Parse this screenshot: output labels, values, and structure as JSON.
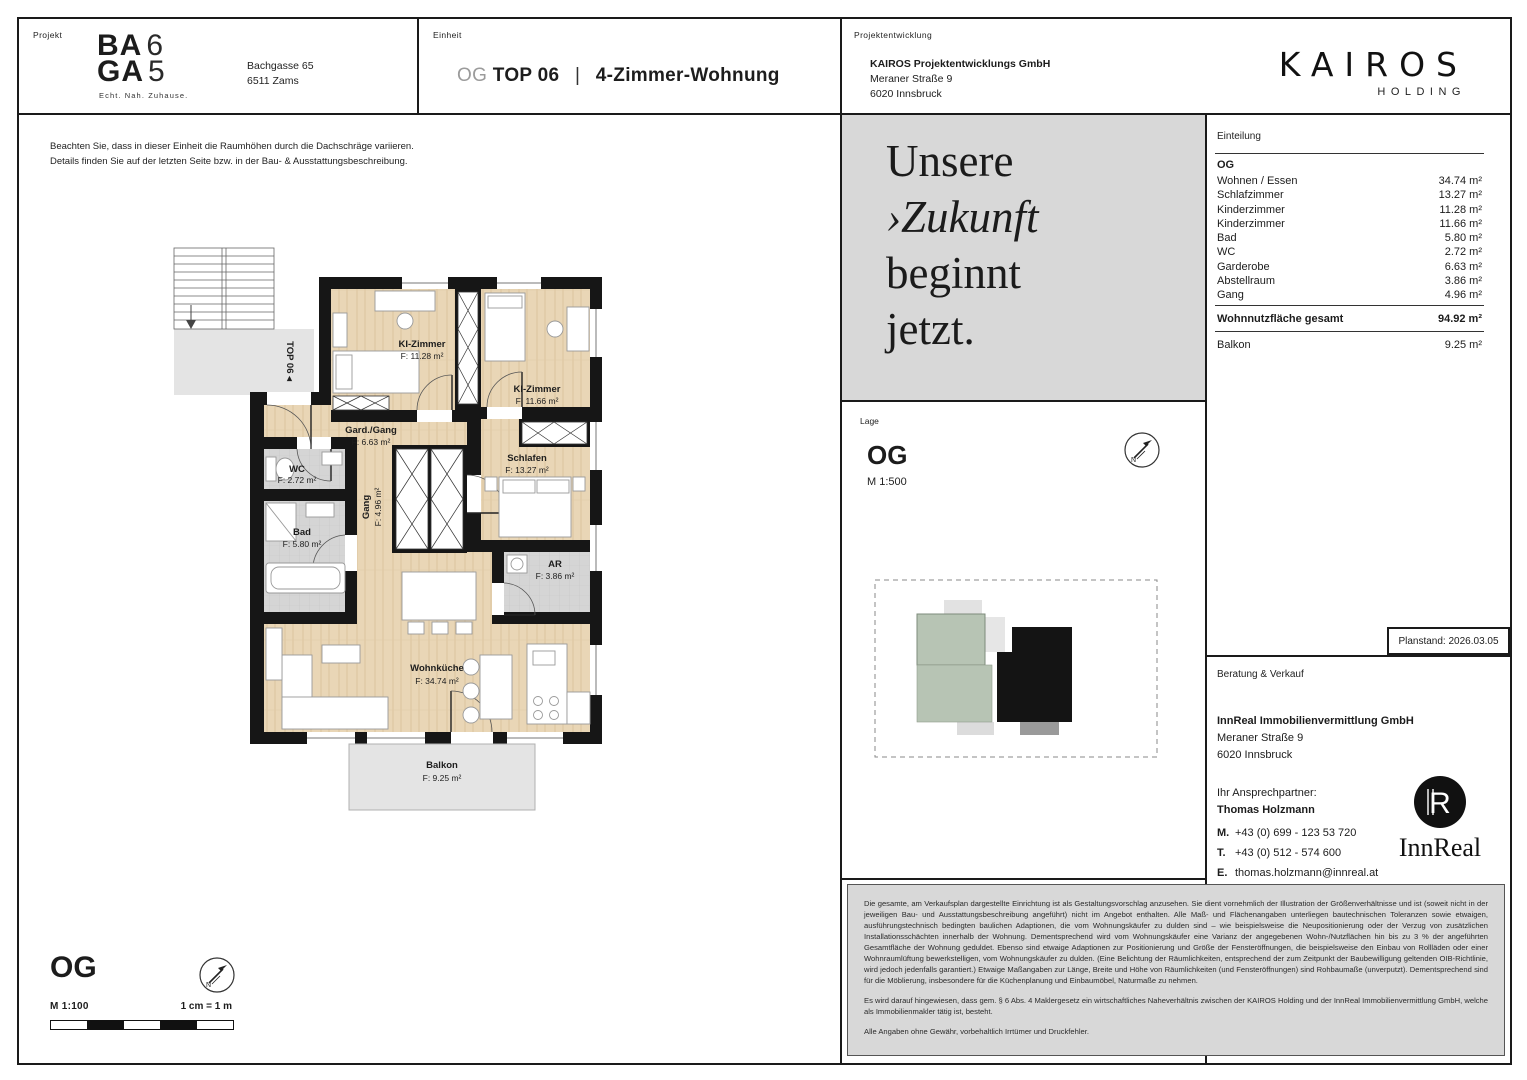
{
  "header": {
    "project_label": "Projekt",
    "logo": {
      "l1b": "BA",
      "l1t": "6",
      "l2b": "GA",
      "l2t": "5",
      "tagline": "Echt. Nah. Zuhause."
    },
    "address_line1": "Bachgasse 65",
    "address_line2": "6511 Zams",
    "unit_label": "Einheit",
    "unit_prefix": "OG",
    "unit_top": "TOP 06",
    "unit_sep": "|",
    "unit_type": "4-Zimmer-Wohnung",
    "dev_label": "Projektentwicklung",
    "dev_company": "KAIROS Projektentwicklungs GmbH",
    "dev_addr1": "Meraner Straße 9",
    "dev_addr2": "6020 Innsbruck",
    "brand_name": "KAIROS",
    "brand_sub": "HOLDING"
  },
  "notes": {
    "line1": "Beachten Sie, dass in dieser Einheit die Raumhöhen durch die Dachschräge variieren.",
    "line2": "Details finden Sie auf der letzten Seite bzw. in der Bau- & Ausstattungsbeschreibung."
  },
  "floorplan": {
    "stair_label": "TOP 06 ◂",
    "rooms": [
      {
        "name": "KI-Zimmer",
        "area": "F: 11.28 m²"
      },
      {
        "name": "KI-Zimmer",
        "area": "F: 11.66 m²"
      },
      {
        "name": "Gard./Gang",
        "area": "F: 6.63 m²"
      },
      {
        "name": "Schlafen",
        "area": "F: 13.27 m²"
      },
      {
        "name": "WC",
        "area": "F: 2.72 m²"
      },
      {
        "name": "Bad",
        "area": "F: 5.80 m²"
      },
      {
        "name": "Gang",
        "area": "F: 4.96 m²"
      },
      {
        "name": "AR",
        "area": "F: 3.86 m²"
      },
      {
        "name": "Wohnküche",
        "area": "F: 34.74 m²"
      },
      {
        "name": "Balkon",
        "area": "F: 9.25 m²"
      }
    ]
  },
  "scale_block": {
    "floor": "OG",
    "scale": "M 1:100",
    "equiv": "1 cm = 1 m"
  },
  "tagline_panel": {
    "lines": [
      "Unsere",
      "›Zukunft",
      "beginnt",
      "jetzt."
    ]
  },
  "lage": {
    "label": "Lage",
    "floor": "OG",
    "scale": "M 1:500"
  },
  "einteilung": {
    "title": "Einteilung",
    "floor": "OG",
    "rows": [
      {
        "label": "Wohnen / Essen",
        "value": "34.74 m²"
      },
      {
        "label": "Schlafzimmer",
        "value": "13.27 m²"
      },
      {
        "label": "Kinderzimmer",
        "value": "11.28 m²"
      },
      {
        "label": "Kinderzimmer",
        "value": "11.66 m²"
      },
      {
        "label": "Bad",
        "value": "5.80 m²"
      },
      {
        "label": "WC",
        "value": "2.72 m²"
      },
      {
        "label": "Garderobe",
        "value": "6.63 m²"
      },
      {
        "label": "Abstellraum",
        "value": "3.86 m²"
      },
      {
        "label": "Gang",
        "value": "4.96 m²"
      }
    ],
    "total_label": "Wohnnutzfläche gesamt",
    "total_value": "94.92 m²",
    "balkon_label": "Balkon",
    "balkon_value": "9.25 m²"
  },
  "planstand": "Planstand: 2026.03.05",
  "sales": {
    "label": "Beratung & Verkauf",
    "company": "InnReal Immobilienvermittlung GmbH",
    "addr1": "Meraner Straße 9",
    "addr2": "6020 Innsbruck",
    "partner_label": "Ihr Ansprechpartner:",
    "partner_name": "Thomas Holzmann",
    "m_label": "M.",
    "m_value": "+43 (0) 699 - 123 53 720",
    "t_label": "T.",
    "t_value": "+43 (0) 512 - 574 600",
    "e_label": "E.",
    "e_value": "thomas.holzmann@innreal.at",
    "logo_word": "InnReal"
  },
  "disclaimer": {
    "p1": "Die gesamte, am Verkaufsplan dargestellte Einrichtung ist als Gestaltungsvorschlag anzusehen. Sie dient vornehmlich der Illustration der Größenverhältnisse und ist (soweit nicht in der jeweiligen Bau- und Ausstattungsbeschreibung angeführt) nicht im Angebot enthalten. Alle Maß- und Flächenangaben unterliegen bautechnischen Toleranzen sowie etwaigen, ausführungstechnisch bedingten baulichen Adaptionen, die vom Wohnungskäufer zu dulden sind – wie beispielsweise die Neupositionierung oder der Verzug von zusätzlichen Installationsschächten innerhalb der Wohnung. Dementsprechend wird vom Wohnungskäufer eine Varianz der angegebenen Wohn-/Nutzflächen hin bis zu 3 % der angeführten Gesamtfläche der Wohnung geduldet. Ebenso sind etwaige Adaptionen zur Positionierung und Größe der Fensteröffnungen, die beispielsweise den Einbau von Rollläden oder einer Wohnraumlüftung bewerkstelligen, vom Wohnungskäufer zu dulden. (Eine Belichtung der Räumlichkeiten, entsprechend der zum Zeitpunkt der Baubewilligung geltenden OIB-Richtlinie, wird jedoch jedenfalls garantiert.) Etwaige Maßangaben zur Länge, Breite und Höhe von Räumlichkeiten (und Fensteröffnungen) sind Rohbaumaße (unverputzt). Dementsprechend sind für die Möblierung, insbesondere für die Küchenplanung und Einbaumöbel, Naturmaße zu nehmen.",
    "p2": "Es wird darauf hingewiesen, dass gem. § 6 Abs. 4 Maklergesetz ein wirtschaftliches Naheverhältnis zwischen der KAIROS Holding und der InnReal Immobilienvermittlung GmbH, welche als Immobilienmakler tätig ist, besteht.",
    "p3": "Alle Angaben ohne Gewähr, vorbehaltlich Irrtümer und Druckfehler."
  },
  "colors": {
    "wood": "#e9d6b6",
    "wall": "#161616",
    "panel_gray": "#d8d8d8",
    "tile": "#d5d5d5",
    "balcony_gray": "#e4e4e4",
    "site_green": "#b7c4b4",
    "site_black": "#141414"
  }
}
